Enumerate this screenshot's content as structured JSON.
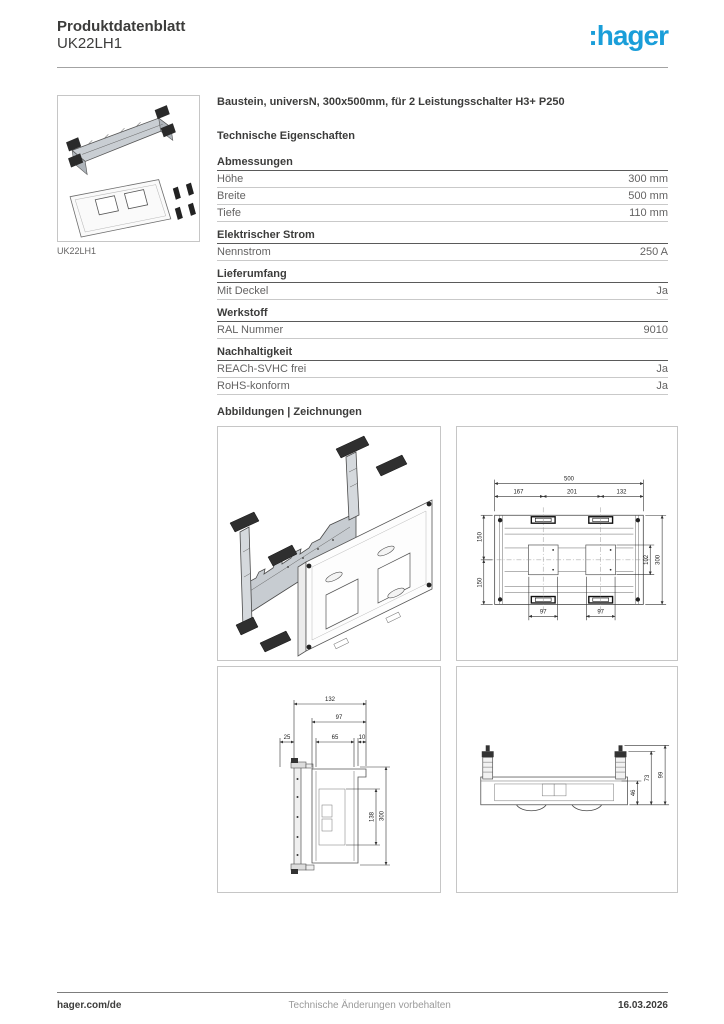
{
  "header": {
    "doc_type": "Produktdatenblatt",
    "product_ref": "UK22LH1",
    "logo_text": ":hager"
  },
  "product": {
    "thumbnail_caption": "UK22LH1",
    "title": "Baustein, universN, 300x500mm, für 2 Leistungsschalter H3+ P250"
  },
  "specs": {
    "heading": "Technische Eigenschaften",
    "sections": [
      {
        "name": "Abmessungen",
        "rows": [
          {
            "label": "Höhe",
            "value": "300 mm"
          },
          {
            "label": "Breite",
            "value": "500 mm"
          },
          {
            "label": "Tiefe",
            "value": "110 mm"
          }
        ]
      },
      {
        "name": "Elektrischer Strom",
        "rows": [
          {
            "label": "Nennstrom",
            "value": "250 A"
          }
        ]
      },
      {
        "name": "Lieferumfang",
        "rows": [
          {
            "label": "Mit Deckel",
            "value": "Ja"
          }
        ]
      },
      {
        "name": "Werkstoff",
        "rows": [
          {
            "label": "RAL Nummer",
            "value": "9010"
          }
        ]
      },
      {
        "name": "Nachhaltigkeit",
        "rows": [
          {
            "label": "REACh-SVHC frei",
            "value": "Ja"
          },
          {
            "label": "RoHS-konform",
            "value": "Ja"
          }
        ]
      }
    ]
  },
  "drawings": {
    "heading": "Abbildungen | Zeichnungen",
    "plan": {
      "total_width": "500",
      "seg_left": "167",
      "seg_mid": "201",
      "seg_right": "132",
      "left_upper": "150",
      "left_lower": "150",
      "inner_height": "102",
      "total_height": "300",
      "slot_left": "97",
      "slot_right": "97"
    },
    "side": {
      "depth_total": "132",
      "depth_inner": "97",
      "offset_left": "25",
      "offset_mid": "65",
      "offset_right": "10",
      "inner_height": "138",
      "height_total": "300"
    },
    "profile": {
      "h_inner": "46",
      "h_mid": "73",
      "h_outer": "99"
    }
  },
  "footer": {
    "site": "hager.com/de",
    "notice": "Technische Änderungen vorbehalten",
    "date": "16.03.2026"
  },
  "colors": {
    "brand_blue": "#1a9ed9"
  }
}
